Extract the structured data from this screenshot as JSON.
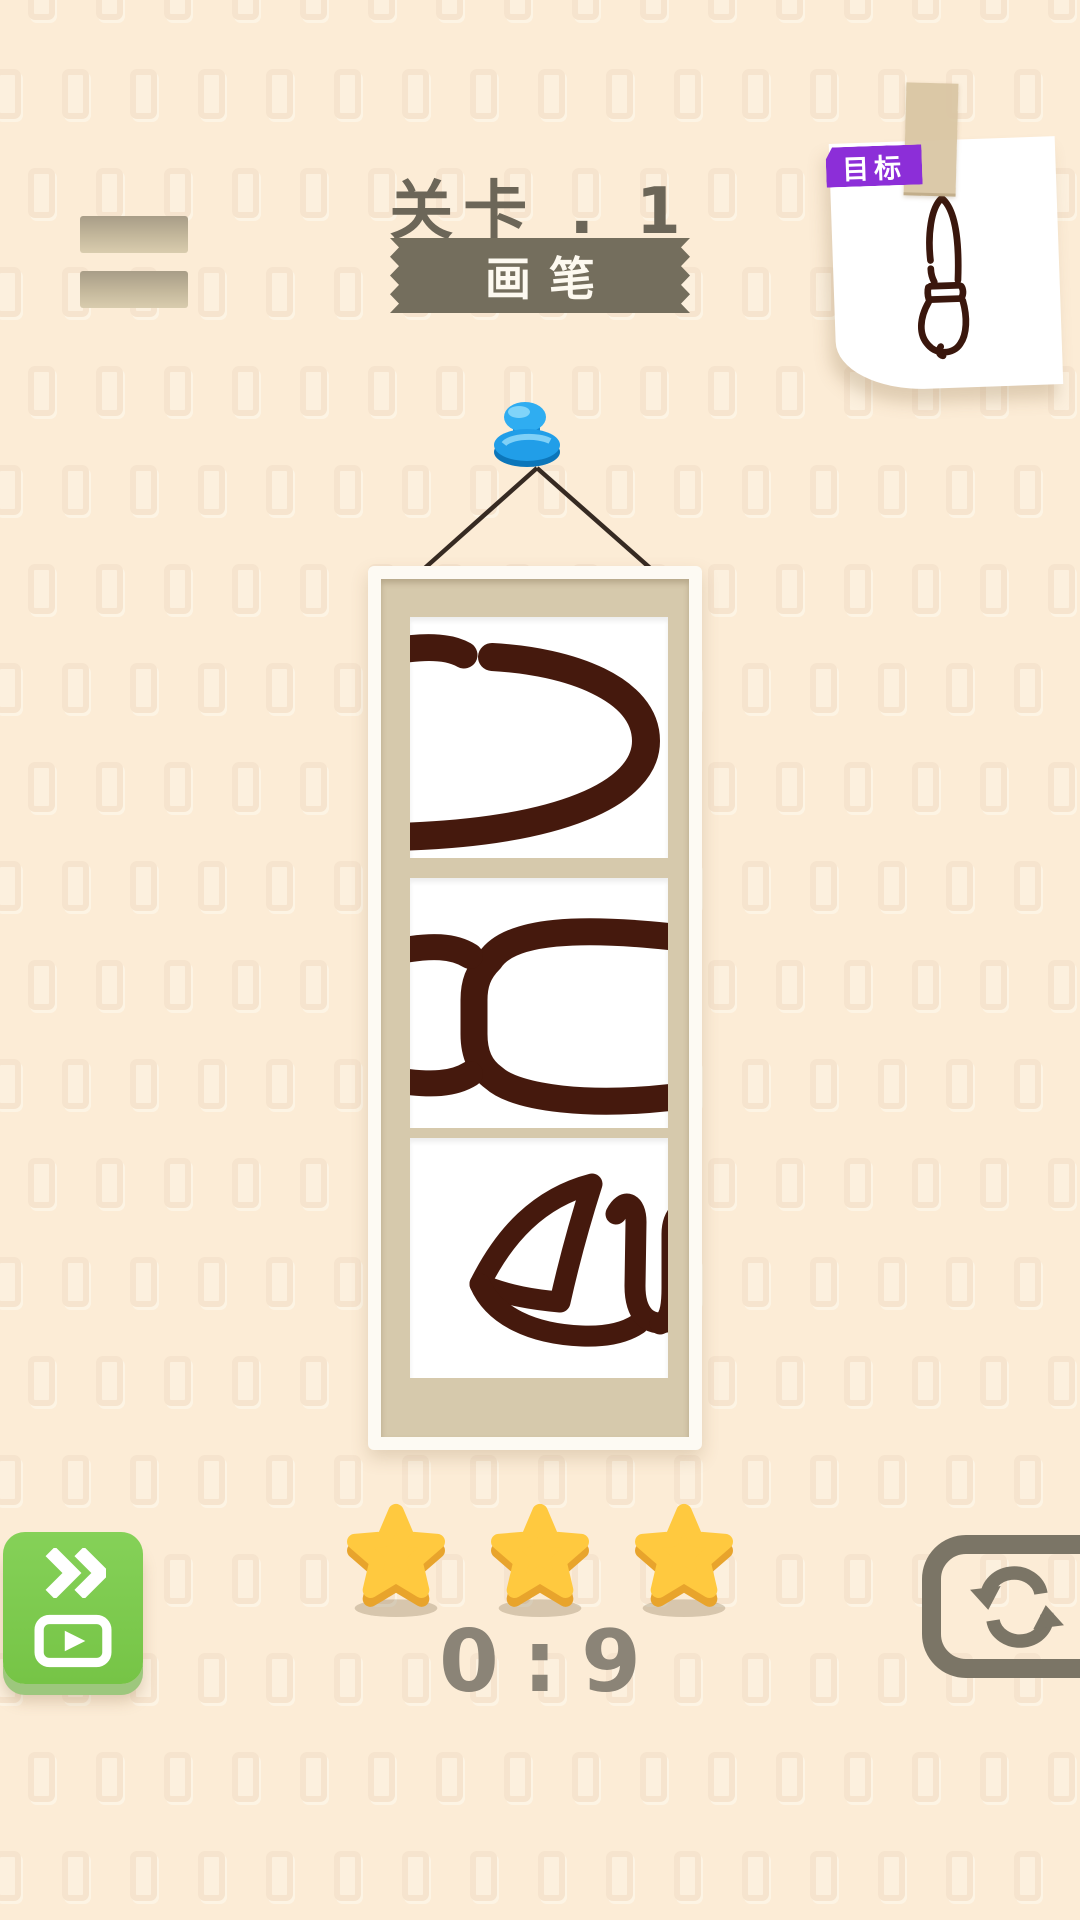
{
  "background": {
    "color": "#fcecd6",
    "pattern_tile_color": "#f4e1ca",
    "pattern": "rounded-rect-grid"
  },
  "header": {
    "level_label": "关卡 . 1",
    "ribbon_label": "画笔",
    "ribbon_color": "#746e5d",
    "text_color": "#6c6658"
  },
  "goal_card": {
    "badge_label": "目标",
    "badge_color": "#8c2ed8",
    "tape_color": "#d9c5a4",
    "drawing": "paintbrush-outline"
  },
  "puzzle": {
    "pin_color": "#2aa7ee",
    "string_color": "#362a22",
    "frame_color": "#fdfaf3",
    "mat_color": "#d6c9ac",
    "stroke_color": "#45190d",
    "pieces": [
      {
        "name": "brush-tip-segment"
      },
      {
        "name": "brush-handle-segment"
      },
      {
        "name": "brush-head-segment"
      }
    ]
  },
  "footer": {
    "stars_count": 3,
    "star_color": "#ffc93f",
    "star_edge_color": "#e8a42c",
    "timer_value": "0:9",
    "timer_color": "#8b8477",
    "skip_button_color": "#7cc84d",
    "skip_icons": [
      "fast-forward-icon",
      "video-play-icon"
    ],
    "restart_icon": "refresh-icon",
    "restart_color": "#7b7566"
  }
}
